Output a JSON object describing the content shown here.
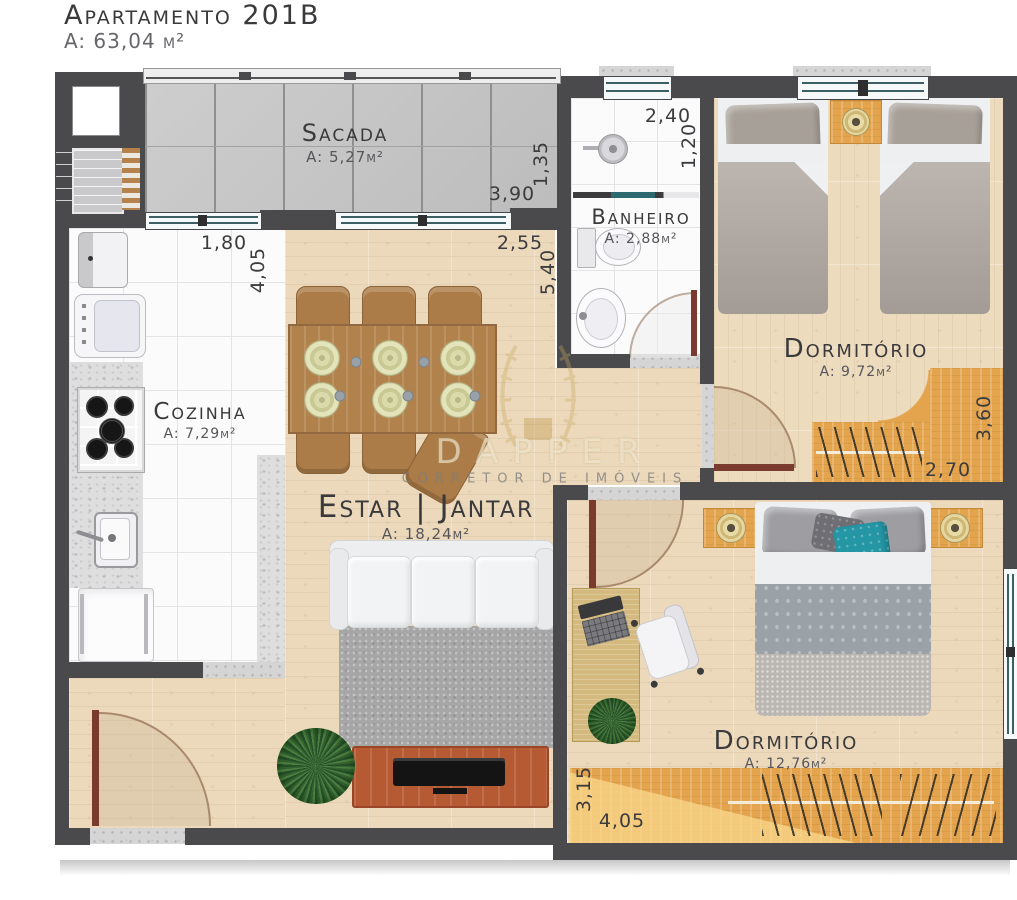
{
  "header": {
    "title": "Apartamento 201B",
    "area": "A: 63,04 m²"
  },
  "watermark": {
    "brand": "DAPPER",
    "tagline": "CORRETOR DE IMÓVEIS"
  },
  "rooms": {
    "sacada": {
      "name": "Sacada",
      "area": "A: 5,27m²"
    },
    "banheiro": {
      "name": "Banheiro",
      "area": "A: 2,88m²"
    },
    "cozinha": {
      "name": "Cozinha",
      "area": "A: 7,29m²"
    },
    "estar": {
      "name": "Estar | Jantar",
      "area": "A: 18,24m²"
    },
    "dorm1": {
      "name": "Dormitório",
      "area": "A: 9,72m²"
    },
    "dorm2": {
      "name": "Dormitório",
      "area": "A: 12,76m²"
    }
  },
  "dims": {
    "sacada_w": "3,90",
    "sacada_d": "1,35",
    "cozinha_w": "1,80",
    "cozinha_d": "4,05",
    "estar_w": "2,55",
    "estar_d": "5,40",
    "banheiro_w": "2,40",
    "banheiro_d": "1,20",
    "dorm1_w": "2,70",
    "dorm1_d": "3,60",
    "dorm2_w": "4,05",
    "dorm2_d": "3,15"
  },
  "colors": {
    "wall": "#4a4a4c",
    "wood_floor": "#ecd9bb",
    "tile": "#fbfbfb",
    "balcony_tile": "#c8c8c8",
    "furniture_wood": "#e3a44d",
    "door": "#7a3b2e",
    "accent_teal": "#2596a4",
    "granite": "#d5d5d5"
  }
}
